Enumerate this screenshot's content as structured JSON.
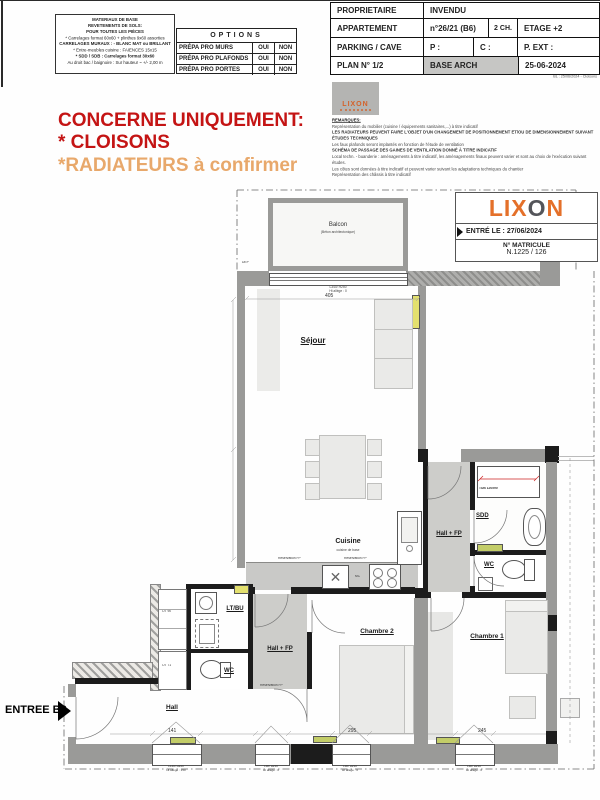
{
  "colors": {
    "accent_red": "#c41414",
    "accent_orange": "#e8a86b",
    "lixon_orange": "#e4702a",
    "lixon_dark": "#54555a",
    "wall_gray": "#9a9a98",
    "corridor_shade": "#cdcdca",
    "radiator_yellow": "#e3e06e",
    "radiator_green": "#c3cd68",
    "base_arch_cell": "#c6c6c4"
  },
  "header": {
    "materials": {
      "l1": "MATERIAUX DE BASE",
      "l2": "REVETEMENTS DE SOLS:",
      "l3": "POUR TOUTES LES PIÈCES",
      "l4": "* Carrelages format 60x60 + plinthes 9x60 assorties",
      "l5": "CARRELAGES MURAUX : - BLANC MAT ou BRILLANT",
      "l6": "* Entre-meubles cuisine : FAIENCES 15x15",
      "l7": "* SDD / SDB : Carrelages format 30x60",
      "l8": "Au droit bac / baignoire : Sur hauteur ~ +/- 2,00 m"
    },
    "options": {
      "title": "OPTIONS",
      "rows": [
        {
          "label": "PRÉPA PRO MURS",
          "opt1": "OUI",
          "opt2": "NON"
        },
        {
          "label": "PRÉPA PRO PLAFONDS",
          "opt1": "OUI",
          "opt2": "NON"
        },
        {
          "label": "PRÉPA PRO PORTES",
          "opt1": "OUI",
          "opt2": "NON"
        }
      ]
    },
    "titleblock": {
      "owner_label": "PROPRIETAIRE",
      "owner_value": "INVENDU",
      "apt_label": "APPARTEMENT",
      "apt_value": "n°26/21 (B6)",
      "apt_rooms": "2 CH.",
      "apt_floor": "ETAGE +2",
      "parking_label": "PARKING / CAVE",
      "parking_p": "P :",
      "parking_c": "C :",
      "parking_ext": "P. EXT :",
      "plan_label": "PLAN N° 1/2",
      "plan_base": "BASE ARCH",
      "plan_date": "25-06-2024",
      "revision": "BL : 25/06/2024 - Cloisons"
    }
  },
  "notice": {
    "line1": "CONCERNE UNIQUEMENT:",
    "line2": "* CLOISONS",
    "line3": "*RADIATEURS à confirmer"
  },
  "remarks": {
    "title": "REMARQUES:",
    "lines": [
      "Représentation du mobilier (cuisine / équipements sanitaires,...) à titre indicatif",
      "LES RADIATEURS PEUVENT FAIRE L'OBJET D'UN CHANGEMENT DE POSITIONNEMENT ET/OU DE DIMENSIONNEMENT SUIVANT ÉTUDES TECHNIQUES",
      "Les faux plafonds seront implantés en fonction de l'étude de ventilation",
      "SCHÉMA DE PASSAGE DES GAINES DE VENTILATION DONNÉ À TITRE INDICATIF",
      "Local techn. - buanderie : aménagements à titre indicatif, les aménagements finaux peuvent varier et sont au choix de l'exécution suivant études.",
      "Les côtes sont données à titre indicatif et peuvent varier suivant les adaptations techniques du chantier",
      "Représentation des châssis à titre indicatif"
    ]
  },
  "stamp_small": {
    "brand": "LIXON"
  },
  "stamp": {
    "brand_l": "LIX",
    "brand_o": "O",
    "brand_n": "N",
    "entered": "ENTRÉ LE : 27/06/2024",
    "matricule_label": "N° MATRICULE",
    "matricule_value": "N.1225 / 126"
  },
  "plan": {
    "rooms": {
      "balcon": "Balcon",
      "balcon_sub": "(Béton architectonique)",
      "sejour": "Séjour",
      "cuisine": "Cuisine",
      "cuisine_sub": "cuisine de base",
      "sdd": "SDD",
      "tub": "TUB 120x90",
      "hall_fp_right": "Hall + FP",
      "wc_right": "WC",
      "chambre1": "Chambre 1",
      "chambre2": "Chambre 2",
      "ltbu": "LT/BU",
      "wc_mid": "WC",
      "hall_fp_mid": "Hall + FP",
      "hall": "Hall",
      "entree": "ENTREE B6"
    },
    "labels": {
      "dep": "DEP",
      "mc": "MC",
      "reservation_fp": "Réservation FP",
      "closet_top": "OT 90",
      "closet_bottom": "OT 71"
    },
    "windows": {
      "bay_code": "L340/ H250",
      "bay_sill": "Ht allège : 0",
      "hall_code": "L140/ H240",
      "hall_sill": "Ht allège : 150",
      "w2_code": "L90/ H210",
      "w2_sill": "Ht allège : 0",
      "w3_code": "L90/ H210",
      "w3_sill": "Ht allège : 0",
      "w4_code": "L90/ H210",
      "w4_sill": "Ht allège : 0"
    },
    "dims": {
      "sejour_width": "405",
      "hall_window": "141",
      "chambre2_window": "295",
      "chambre1_window": "245"
    }
  }
}
